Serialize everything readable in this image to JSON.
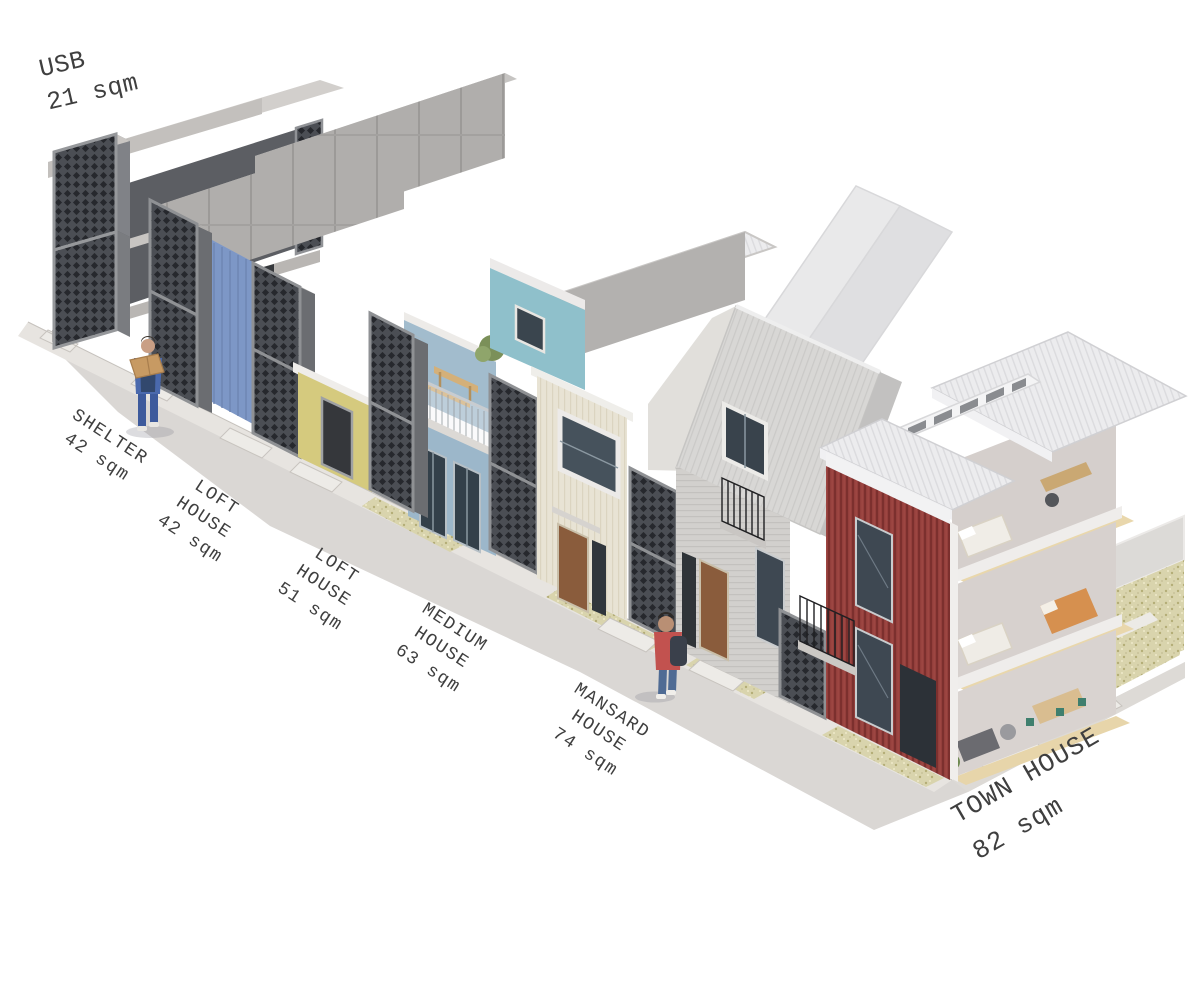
{
  "houses": [
    {
      "id": "usb",
      "name": "USB",
      "area": "21 sqm",
      "lines": [
        "USB",
        "21 sqm"
      ]
    },
    {
      "id": "shelter",
      "name": "SHELTER",
      "area": "42 sqm",
      "lines": [
        "SHELTER",
        "42 sqm"
      ]
    },
    {
      "id": "loft-house-42",
      "name": "LOFT HOUSE",
      "area": "42 sqm",
      "lines": [
        "LOFT",
        "HOUSE",
        "42 sqm"
      ]
    },
    {
      "id": "loft-house-51",
      "name": "LOFT HOUSE",
      "area": "51 sqm",
      "lines": [
        "LOFT",
        "HOUSE",
        "51 sqm"
      ]
    },
    {
      "id": "medium-house",
      "name": "MEDIUM HOUSE",
      "area": "63 sqm",
      "lines": [
        "MEDIUM",
        "HOUSE",
        "63 sqm"
      ]
    },
    {
      "id": "mansard-house",
      "name": "MANSARD HOUSE",
      "area": "74 sqm",
      "lines": [
        "MANSARD",
        "HOUSE",
        "74 sqm"
      ]
    },
    {
      "id": "town-house",
      "name": "TOWN HOUSE",
      "area": "82 sqm",
      "lines": [
        "TOWN HOUSE",
        "82 sqm"
      ]
    }
  ],
  "colors": {
    "street_gray": "#dad7d4",
    "sidewalk_gray": "#e7e4e0",
    "lattice_dark": "#4b4e54",
    "bar_gray": "#b0aeac",
    "tarp_blue": "#7d97c6",
    "loft42_yellow": "#d5ca7e",
    "loft51_blue": "#9cb7ca",
    "medium_cream": "#e8e3d4",
    "medium_teal": "#8fc0cb",
    "mansard_roof_gray": "#d8d7d5",
    "town_red": "#943f3c",
    "wood_floor": "#e9d7ac",
    "label_ink": "#3f3f3f"
  }
}
